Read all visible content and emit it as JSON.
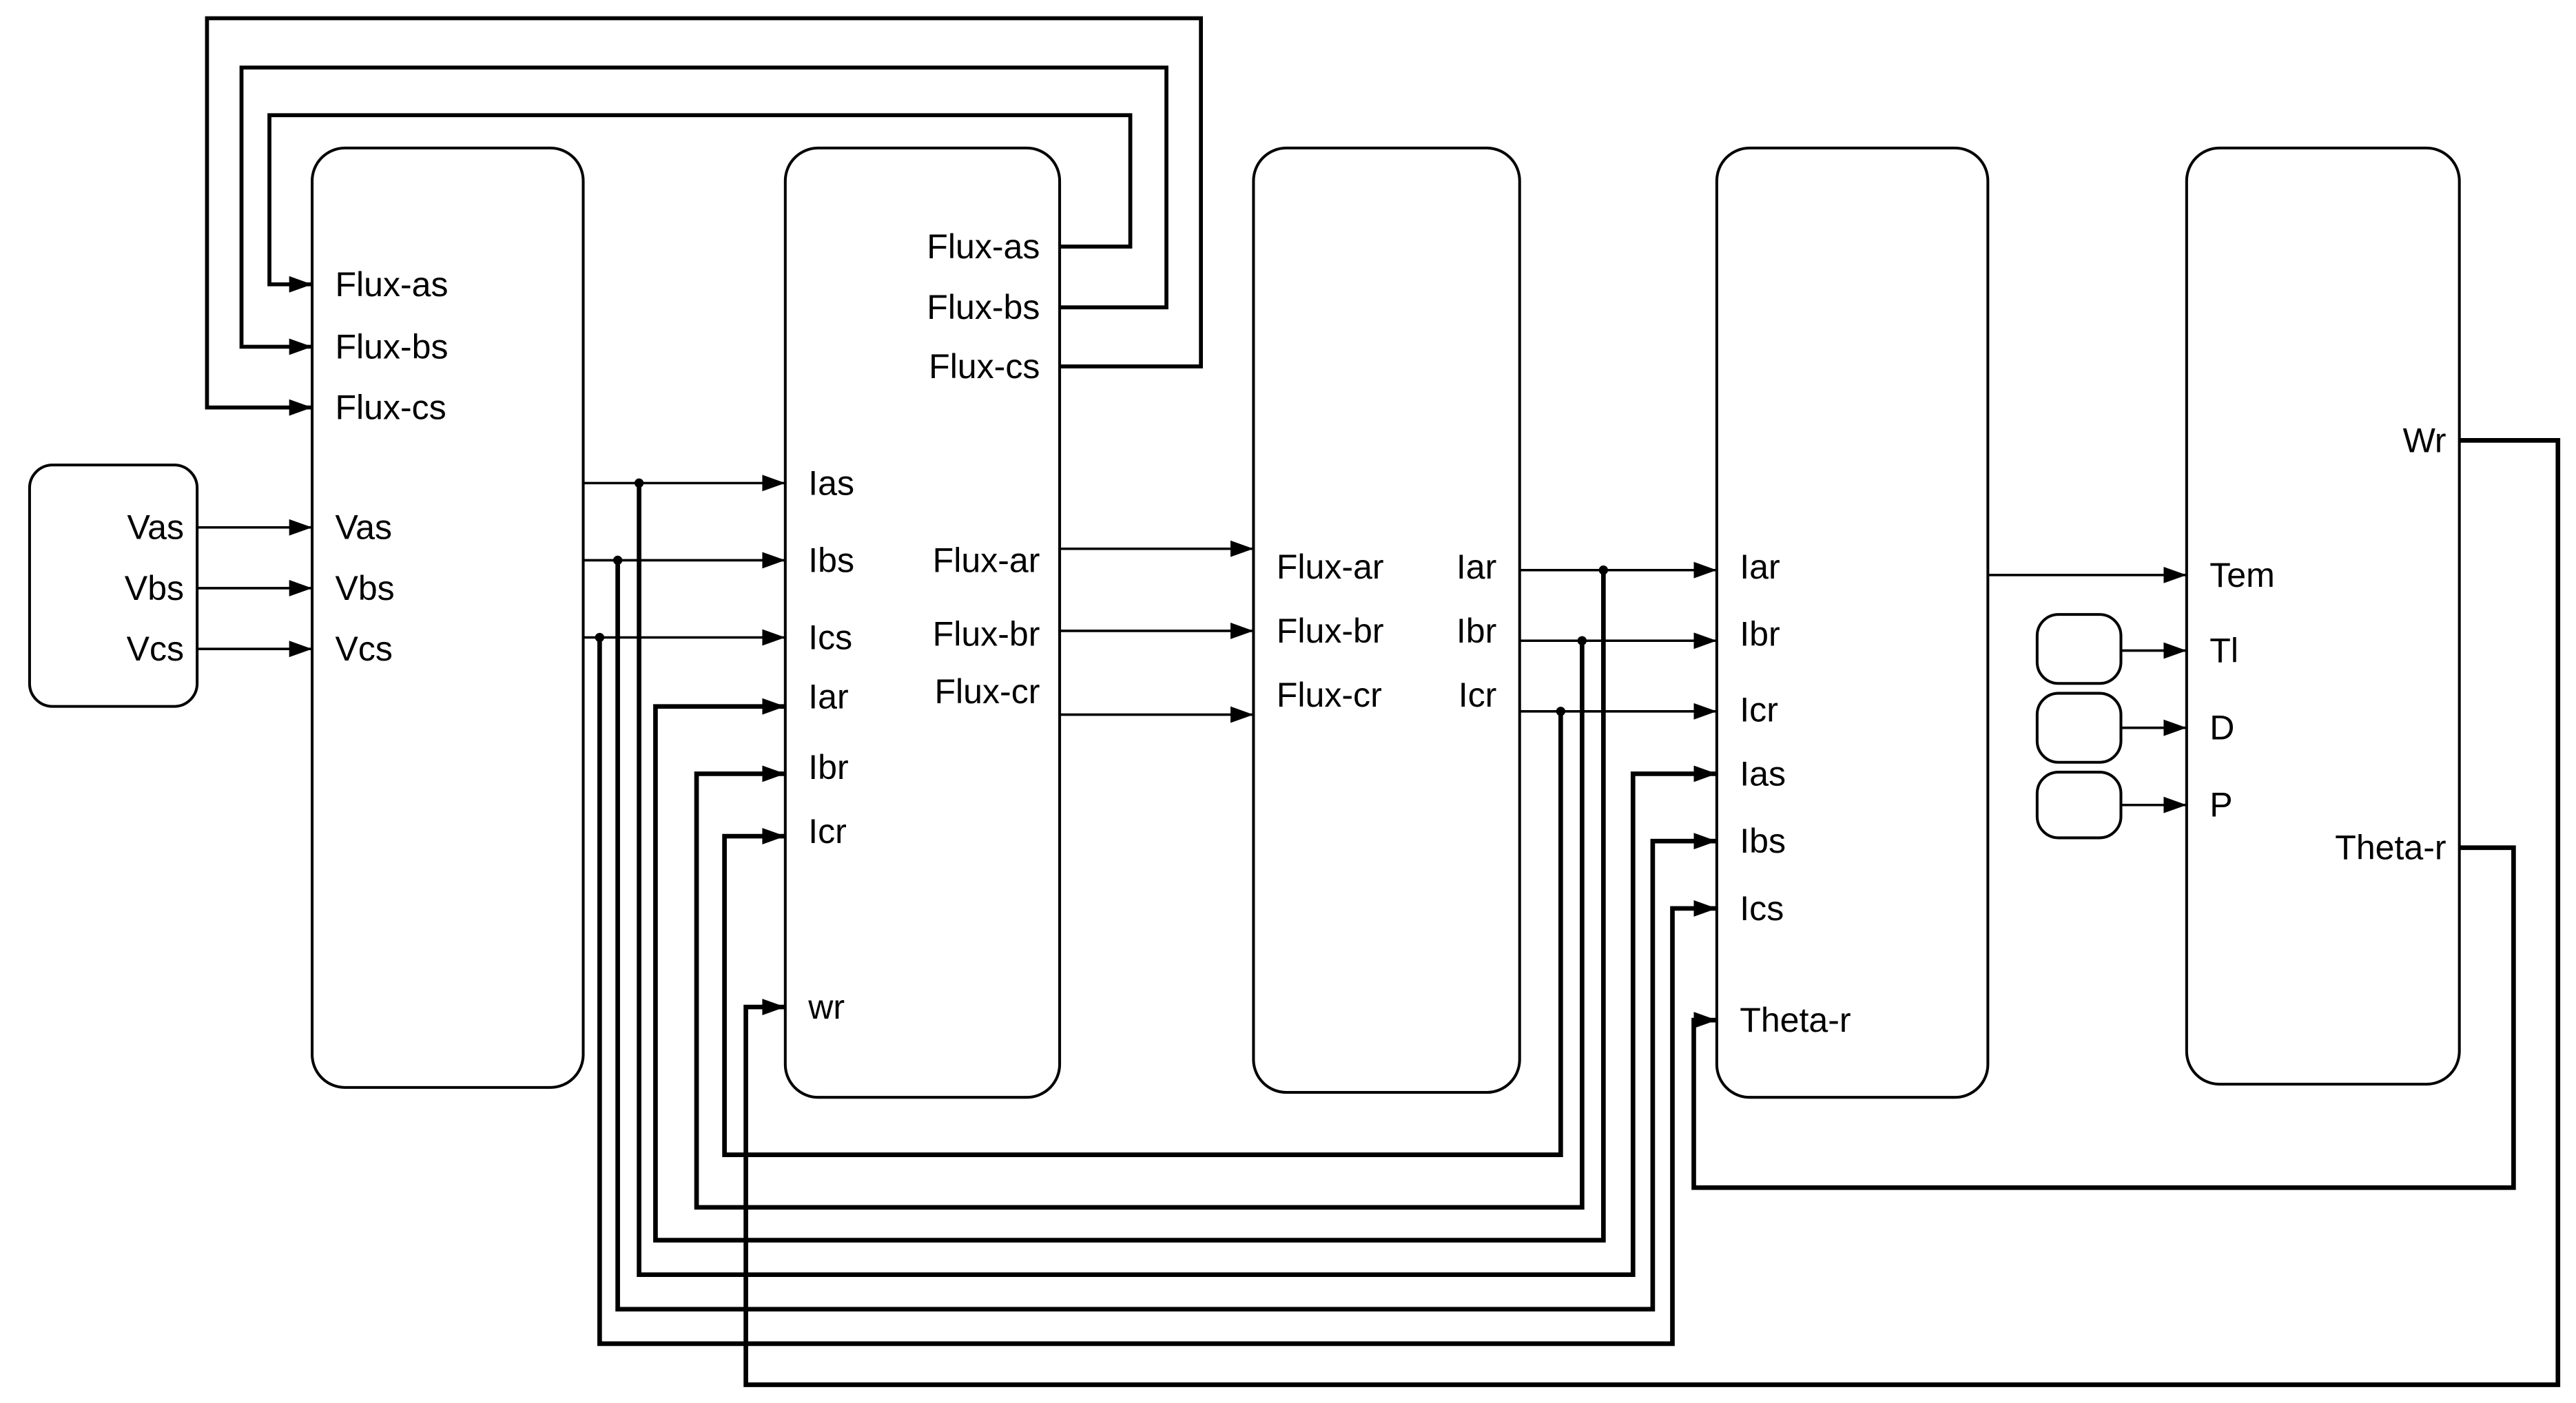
{
  "colors": {
    "line": "#000000",
    "background": "#ffffff"
  },
  "blocks": {
    "source": {
      "outputs": [
        "Vas",
        "Vbs",
        "Vcs"
      ]
    },
    "block2": {
      "inputs": [
        "Flux-as",
        "Flux-bs",
        "Flux-cs",
        "Vas",
        "Vbs",
        "Vcs"
      ]
    },
    "block3": {
      "feedback_outputs": [
        "Flux-as",
        "Flux-bs",
        "Flux-cs"
      ],
      "inputs": [
        "Ias",
        "Ibs",
        "Ics",
        "Iar",
        "Ibr",
        "Icr",
        "wr"
      ],
      "outputs": [
        "Flux-ar",
        "Flux-br",
        "Flux-cr"
      ]
    },
    "block4": {
      "inputs": [
        "Flux-ar",
        "Flux-br",
        "Flux-cr"
      ],
      "outputs": [
        "Iar",
        "Ibr",
        "Icr"
      ]
    },
    "block5": {
      "inputs": [
        "Iar",
        "Ibr",
        "Icr",
        "Ias",
        "Ibs",
        "Ics",
        "Theta-r"
      ]
    },
    "block6": {
      "inputs": [
        "Tem",
        "Tl",
        "D",
        "P"
      ],
      "outputs": [
        "Wr",
        "Theta-r"
      ]
    }
  }
}
